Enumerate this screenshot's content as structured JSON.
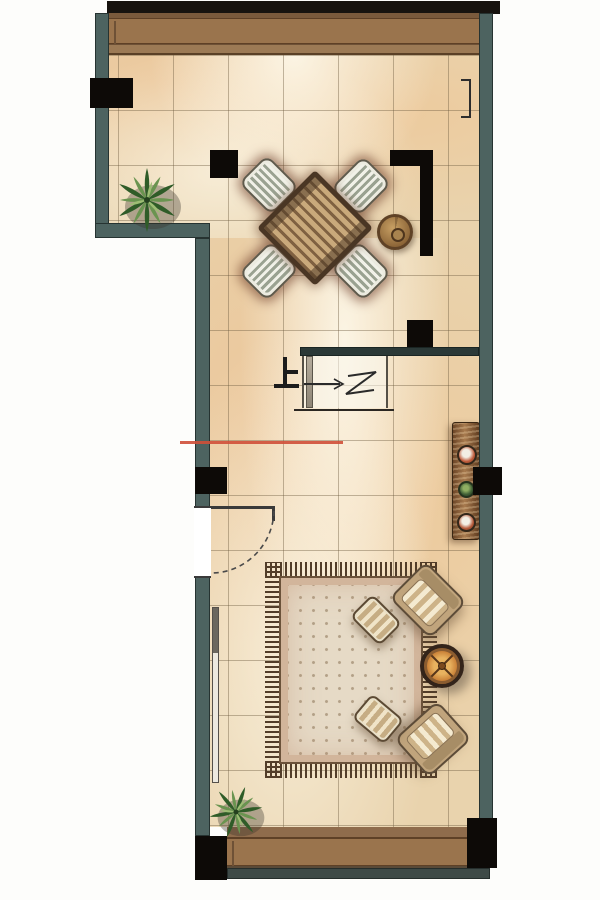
{
  "page": {
    "background": "#ffffff",
    "description": "Hand-rendered watercolor interior floor plan, single level, L-shaped room"
  },
  "plan": {
    "stairs": {
      "up_label": "上",
      "up_label_meaning": "up (stair direction)",
      "break_symbol": "z",
      "tread_count": 6
    },
    "door": {
      "type": "single-swing",
      "wall": "left",
      "swing": "open-arc-shown"
    },
    "windows": {
      "top": {
        "count": 7,
        "style": "x-hatched"
      },
      "bottom": {
        "count": 5,
        "style": "x-hatched"
      }
    },
    "colors": {
      "wall_teal": "#4d6360",
      "structure_black": "#0d0a07",
      "floor_tan": "#e9d3ad",
      "tile_line": "#6e5c40",
      "window_frame_brown": "#9a744d",
      "window_pane": "#fbf8ee",
      "beam_dark": "#2b3937",
      "rug_field": "#e6dac6",
      "rug_fringe": "#523d29",
      "console_wood": "#8a5f3e",
      "side_table_orange": "#c87e35",
      "plant_green": "#44702f",
      "accent_line_red": "#cf4f38"
    },
    "furniture": {
      "dining": [
        "dining-table",
        "dining-chair",
        "dining-chair",
        "dining-chair",
        "dining-chair",
        "rattan-stool"
      ],
      "living": [
        "area-rug",
        "armchair",
        "armchair",
        "ottoman",
        "ottoman",
        "round-side-table",
        "console-cabinet",
        "tv-panel"
      ],
      "plants": [
        "corner-plant",
        "corner-plant"
      ]
    }
  }
}
